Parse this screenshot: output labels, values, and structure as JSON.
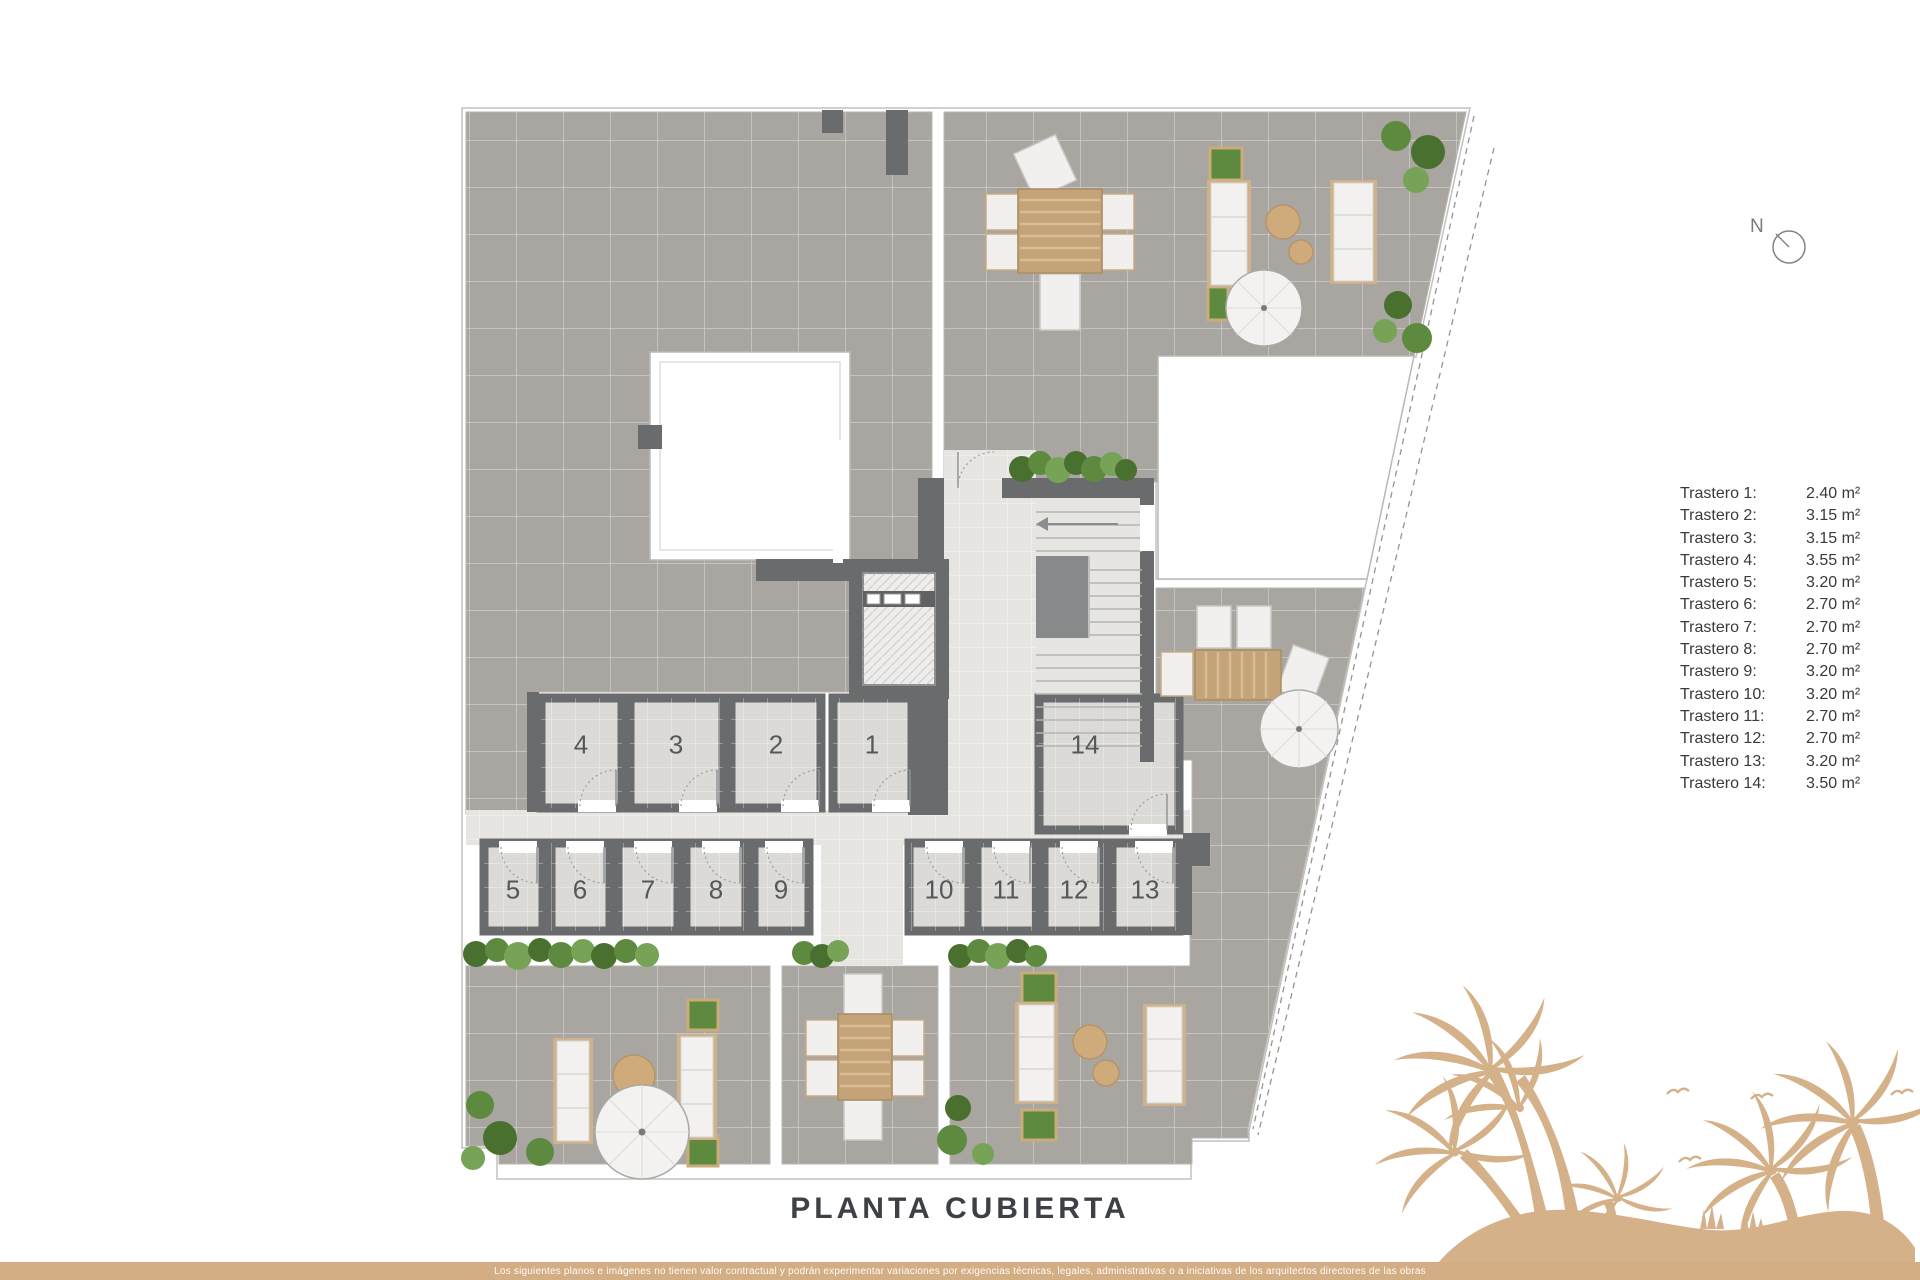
{
  "title": "PLANTA CUBIERTA",
  "compass": {
    "label": "N"
  },
  "plan": {
    "rooms": [
      {
        "label": "1"
      },
      {
        "label": "2"
      },
      {
        "label": "3"
      },
      {
        "label": "4"
      },
      {
        "label": "5"
      },
      {
        "label": "6"
      },
      {
        "label": "7"
      },
      {
        "label": "8"
      },
      {
        "label": "9"
      },
      {
        "label": "10"
      },
      {
        "label": "11"
      },
      {
        "label": "12"
      },
      {
        "label": "13"
      },
      {
        "label": "14"
      }
    ]
  },
  "legend": {
    "items": [
      {
        "label": "Trastero 1:",
        "value": "2.40 m²"
      },
      {
        "label": "Trastero 2:",
        "value": "3.15 m²"
      },
      {
        "label": "Trastero 3:",
        "value": "3.15 m²"
      },
      {
        "label": "Trastero 4:",
        "value": "3.55 m²"
      },
      {
        "label": "Trastero 5:",
        "value": "3.20 m²"
      },
      {
        "label": "Trastero 6:",
        "value": "2.70 m²"
      },
      {
        "label": "Trastero 7:",
        "value": "2.70 m²"
      },
      {
        "label": "Trastero 8:",
        "value": "2.70 m²"
      },
      {
        "label": "Trastero 9:",
        "value": "3.20 m²"
      },
      {
        "label": "Trastero 10:",
        "value": "3.20 m²"
      },
      {
        "label": "Trastero 11:",
        "value": "2.70 m²"
      },
      {
        "label": "Trastero 12:",
        "value": "2.70 m²"
      },
      {
        "label": "Trastero 13:",
        "value": "3.20 m²"
      },
      {
        "label": "Trastero 14:",
        "value": "3.50 m²"
      }
    ]
  },
  "footer": {
    "disclaimer": "Los siguientes planos e imágenes no tienen valor contractual y podrán experimentar variaciones por exigencias técnicas, legales, administrativas o a iniciativas de los arquitectos directores de las obras"
  },
  "colors": {
    "accent_gold": "#d3ae84",
    "terrace_gray": "#a9a6a1",
    "wall_gray": "#696b6d",
    "room_tile": "#dbdad7",
    "corridor_tile": "#e6e5e2",
    "wood": "#c3a377",
    "plant_green": "#5d8a3e",
    "text_dark": "#3d4145"
  }
}
